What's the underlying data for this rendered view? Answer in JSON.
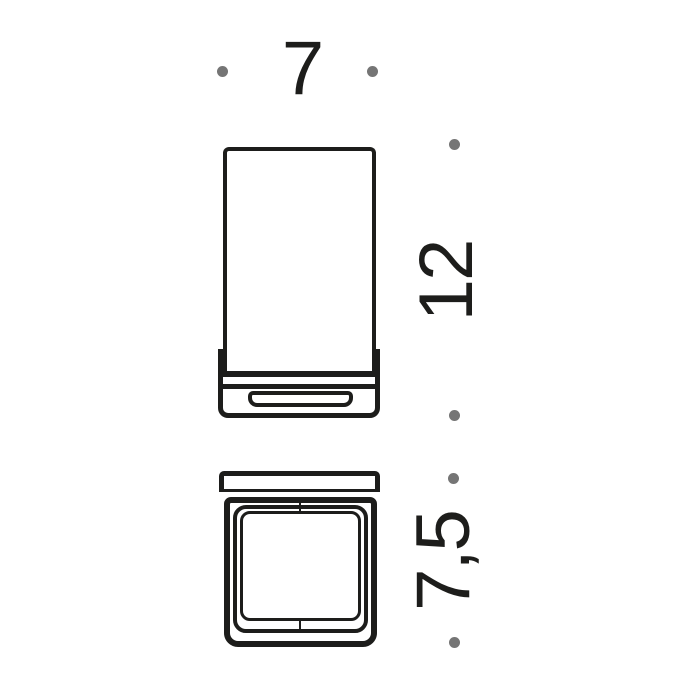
{
  "drawing": {
    "kind": "product-dimension-drawing",
    "subject": "wall-mounted square glass tumbler holder",
    "views": {
      "front": "front-elevation",
      "plan": "bottom-plan-view"
    }
  },
  "colors": {
    "line": "#1d1d1b",
    "dot": "#757575",
    "background": "#ffffff"
  },
  "annotations": {
    "width": {
      "label": "7",
      "orientation": "horizontal",
      "marks_span_of": "front-view width"
    },
    "height": {
      "label": "12",
      "orientation": "vertical",
      "marks_span_of": "front-view height"
    },
    "depth": {
      "label": "7,5",
      "orientation": "vertical",
      "marks_span_of": "plan-view depth"
    }
  }
}
